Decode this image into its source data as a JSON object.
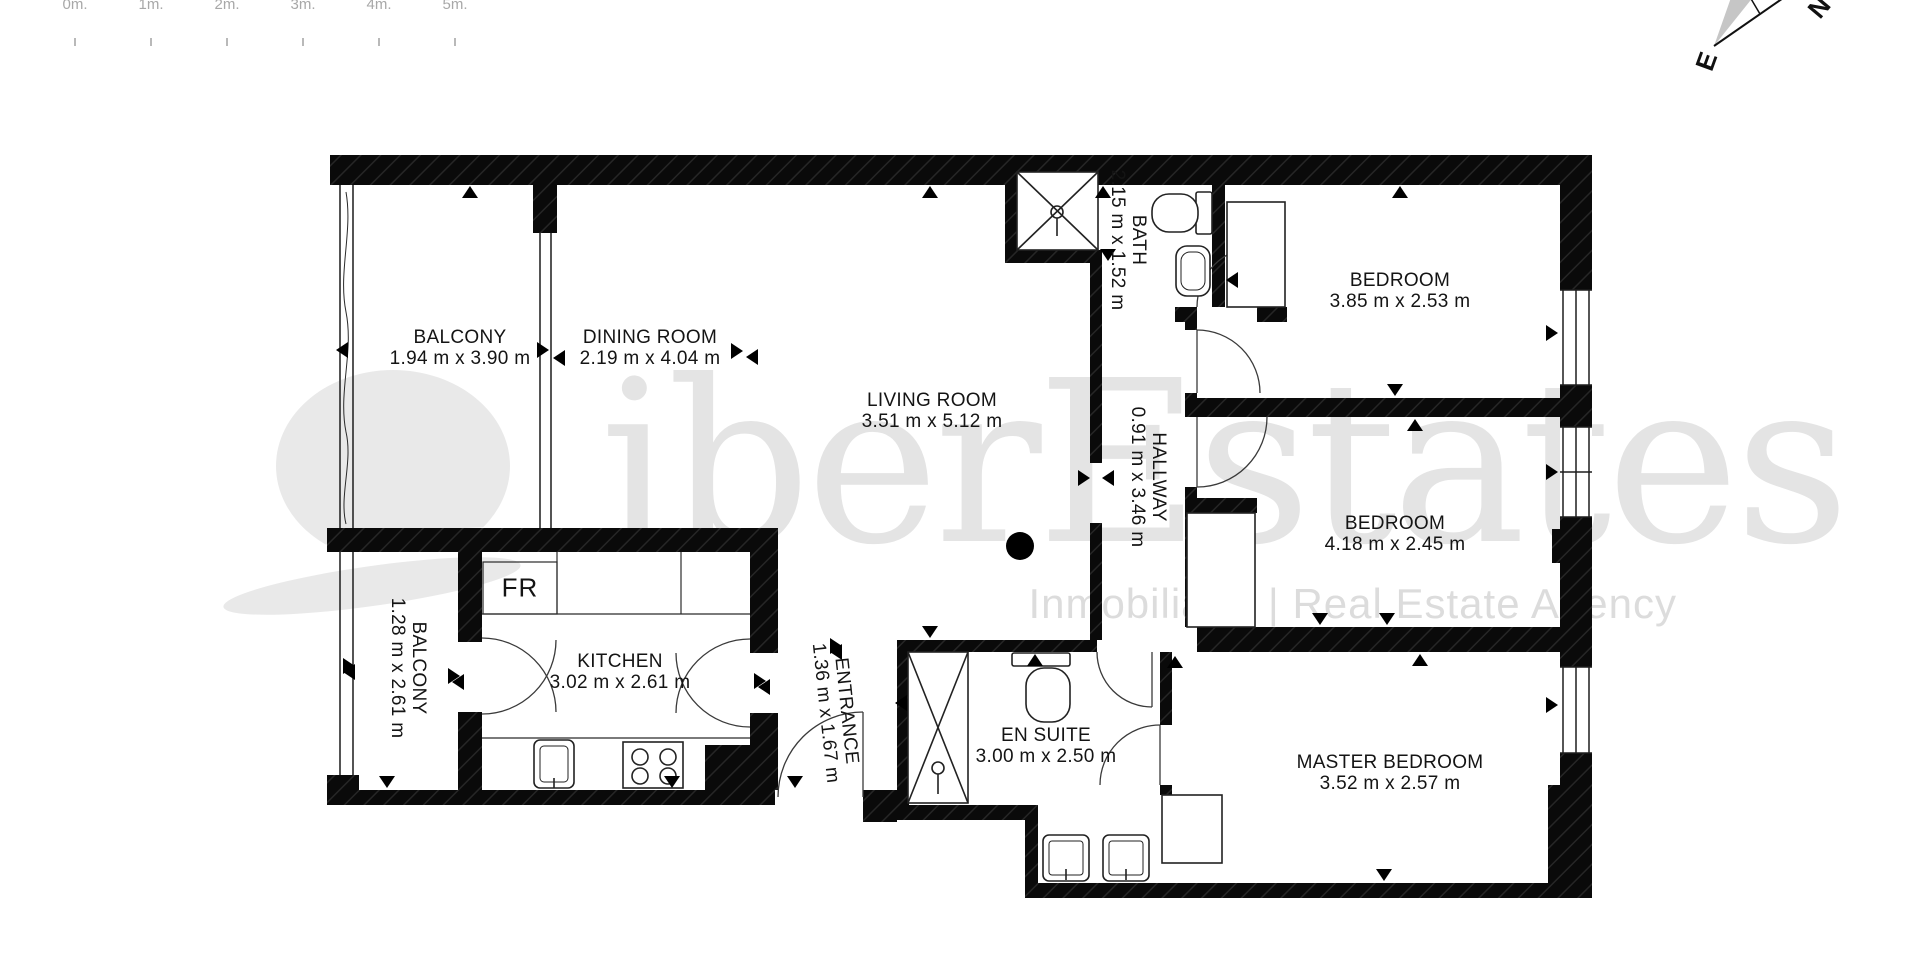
{
  "watermark": {
    "brand": "iberEstates",
    "tagline": "Inmobiliaria | Real Estate Agency"
  },
  "scale_bar": {
    "labels": [
      "0m.",
      "1m.",
      "2m.",
      "3m.",
      "4m.",
      "5m."
    ]
  },
  "compass": {
    "north_label": "N",
    "east_label": "E"
  },
  "appliances": {
    "fridge_label": "FR"
  },
  "rooms": {
    "balcony1": {
      "name": "BALCONY",
      "dims": "1.94 m x 3.90 m"
    },
    "dining": {
      "name": "DINING ROOM",
      "dims": "2.19 m x 4.04 m"
    },
    "living": {
      "name": "LIVING ROOM",
      "dims": "3.51 m x 5.12 m"
    },
    "bath": {
      "name": "BATH",
      "dims": "2.15 m x 1.52 m"
    },
    "bedroom1": {
      "name": "BEDROOM",
      "dims": "3.85 m x 2.53 m"
    },
    "hallway": {
      "name": "HALLWAY",
      "dims": "0.91 m x 3.46 m"
    },
    "bedroom2": {
      "name": "BEDROOM",
      "dims": "4.18 m x 2.45 m"
    },
    "balcony2": {
      "name": "BALCONY",
      "dims": "1.28 m x 2.61 m"
    },
    "kitchen": {
      "name": "KITCHEN",
      "dims": "3.02 m x 2.61 m"
    },
    "entrance": {
      "name": "ENTRANCE",
      "dims": "1.36 m x 1.67 m"
    },
    "ensuite": {
      "name": "EN SUITE",
      "dims": "3.00 m x 2.50 m"
    },
    "master": {
      "name": "MASTER BEDROOM",
      "dims": "3.52 m x 2.57 m"
    }
  }
}
